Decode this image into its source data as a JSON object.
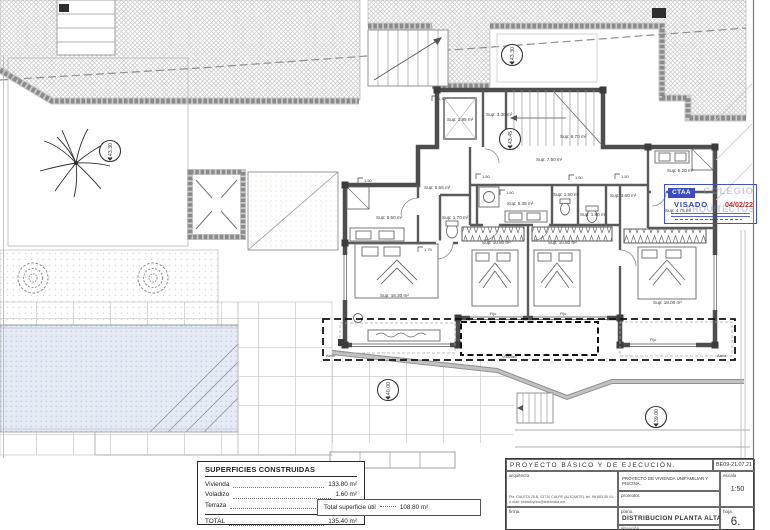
{
  "plan": {
    "levels": [
      {
        "value": "143.30"
      },
      {
        "value": "143.30"
      },
      {
        "value": "143.45"
      },
      {
        "value": "140.00"
      },
      {
        "value": "139.00"
      }
    ],
    "rooms": [
      {
        "sup": "Sup: 1.95 m²"
      },
      {
        "sup": "Sup: 3.30 m²"
      },
      {
        "sup": "Sup: 6.70 m²"
      },
      {
        "sup": "Sup: 7.50 m²"
      },
      {
        "sup": "Sup: 5.55 m²"
      },
      {
        "sup": "Sup: 5.50 m²"
      },
      {
        "sup": "Sup: 1.70 m²"
      },
      {
        "sup": "Sup: 5.35 m²"
      },
      {
        "sup": "Sup: 1.50 m²"
      },
      {
        "sup": "Sup: 1.80 m²"
      },
      {
        "sup": "Sup: 3.60 m²"
      },
      {
        "sup": "Sup: 5.20 m²"
      },
      {
        "sup": "Sup: 4.75 m²"
      },
      {
        "sup": "Sup: 16.30 m²"
      },
      {
        "sup": "Sup: 10.80 m²"
      },
      {
        "sup": "Sup: 10.80 m²"
      },
      {
        "sup": "Sup: 18.00 m²"
      }
    ],
    "dims": [
      {
        "value": "1.40"
      },
      {
        "value": "1.50"
      },
      {
        "value": "1.50"
      },
      {
        "value": "1.50"
      },
      {
        "value": "1.75"
      },
      {
        "value": "1.50"
      },
      {
        "value": "1.50"
      }
    ],
    "fijo_labels": [
      {
        "value": "Fijo"
      },
      {
        "value": "Fijo"
      },
      {
        "value": "Fijo"
      }
    ],
    "alero_left": "Alero",
    "alero_right": "Alero",
    "voladizo": "Voladizo"
  },
  "areas_table": {
    "title": "SUPERFICIES CONSTRUIDAS",
    "rows": [
      {
        "label": "Vivienda",
        "value": "133.80 m²"
      },
      {
        "label": "Voladizo",
        "value": "1.60 m²"
      },
      {
        "label": "Terraza",
        "value": "17.20 m²"
      }
    ],
    "total_label": "TOTAL",
    "total_value": "135.40 m²"
  },
  "useful_area": {
    "label": "Total superficie útil",
    "value": "108.80 m²"
  },
  "title_block": {
    "project_type": "PROYECTO  BÁSICO  Y  DE  EJECUCIÓN.",
    "code": "BE09-21.07.21",
    "architect_label": "arquitecto.",
    "architect_info": "Pla. CALETA 25-B, 03710 CALPE (ALICANTE). tel. 96 583 35 44. e-mail: pintadoyrico@telefonica.net",
    "project_title": "PROYECTO DE VIVIENDA UNIFAMILIAR Y PISCINA.",
    "promoter_label": "promotor.",
    "scale_label": "escala",
    "scale_value": "1:50",
    "signature_label": "firma.",
    "plan_label": "plano.",
    "plan_name": "DISTRIBUCION  PLANTA  ALTA",
    "location_label": "situación.",
    "sheet_label": "hoja.",
    "sheet_number": "6."
  },
  "stamp": {
    "logo": "CTAA",
    "watermark_line1": "COLEGIO",
    "watermark_line2": "ARQUITECTOS",
    "visado_label": "VISADO",
    "date": "04/02/22",
    "accent_blue": "#3f4fc5",
    "date_red": "#b9312e"
  }
}
